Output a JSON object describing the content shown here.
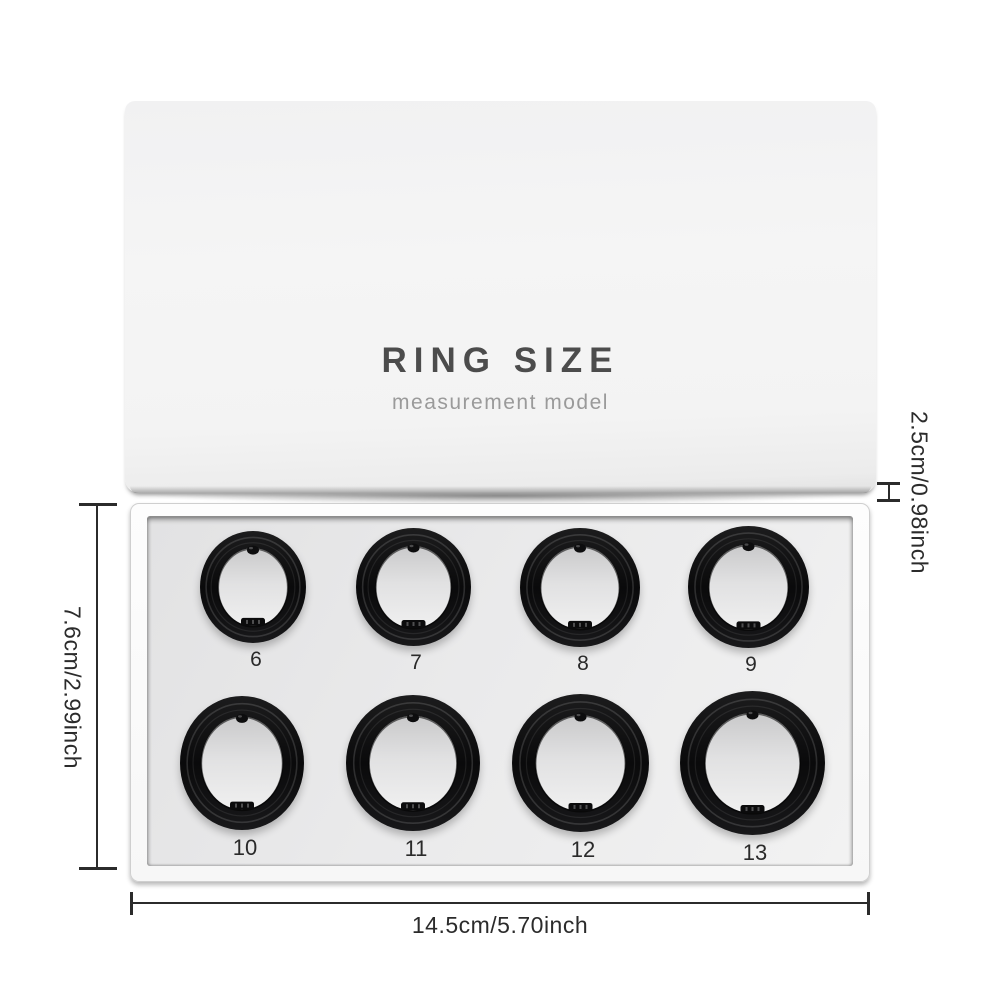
{
  "lid": {
    "title": "RING SIZE",
    "subtitle": "measurement model"
  },
  "rings": {
    "top_row": [
      {
        "size": "6"
      },
      {
        "size": "7"
      },
      {
        "size": "8"
      },
      {
        "size": "9"
      }
    ],
    "bottom_row": [
      {
        "size": "10"
      },
      {
        "size": "11"
      },
      {
        "size": "12"
      },
      {
        "size": "13"
      }
    ]
  },
  "dimensions": {
    "box_width": "14.5cm/5.70inch",
    "box_depth": "7.6cm/2.99inch",
    "lid_height": "2.5cm/0.98inch"
  },
  "colors": {
    "background": "#ffffff",
    "ring_black": "#0d0d0e",
    "tray_floor": "#e9e9ea",
    "lid_title_text": "#4c4c4c",
    "lid_subtitle_text": "#9a9a9a",
    "dimension_text": "#2b2b2b"
  }
}
